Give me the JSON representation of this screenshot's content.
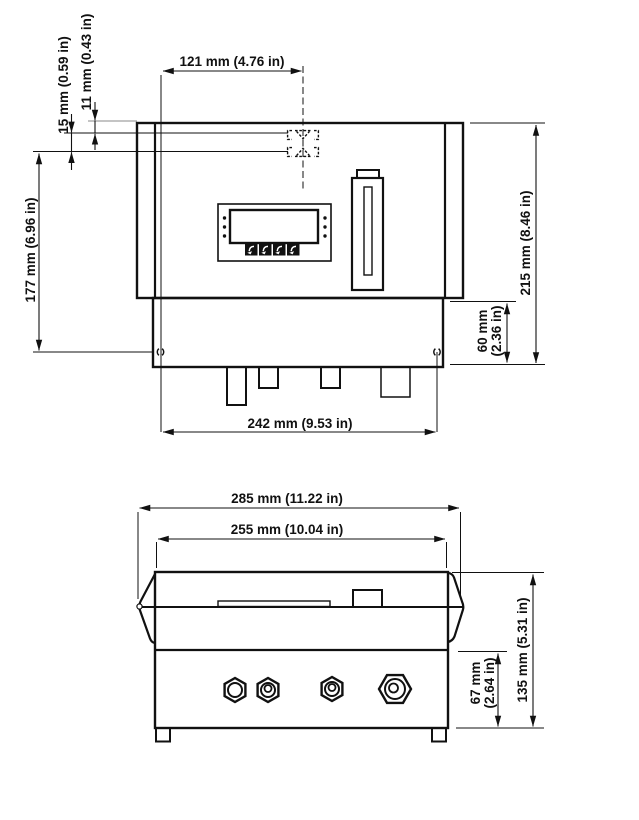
{
  "figure": {
    "type": "engineering-dimension-drawing",
    "front_view": {
      "labels": {
        "panel_width": "121 mm (4.76 in)",
        "keyhole_top_offset": "11 mm (0.43 in)",
        "keyhole_slot_length": "15 mm (0.59 in)",
        "mounting_height": "177 mm (6.96 in)",
        "overall_height": "215 mm (8.46 in)",
        "base_height_line1": "60 mm",
        "base_height_line2": "(2.36 in)",
        "mounting_width": "242 mm (9.53 in)"
      }
    },
    "bottom_view": {
      "labels": {
        "overall_width": "285 mm (11.22 in)",
        "body_width": "255 mm (10.04 in)",
        "lower_section_height_line1": "67 mm",
        "lower_section_height_line2": "(2.64 in)",
        "overall_depth": "135 mm (5.31 in)"
      }
    },
    "colors": {
      "line": "#111111",
      "thin_reference": "#888888",
      "background": "#ffffff"
    }
  }
}
